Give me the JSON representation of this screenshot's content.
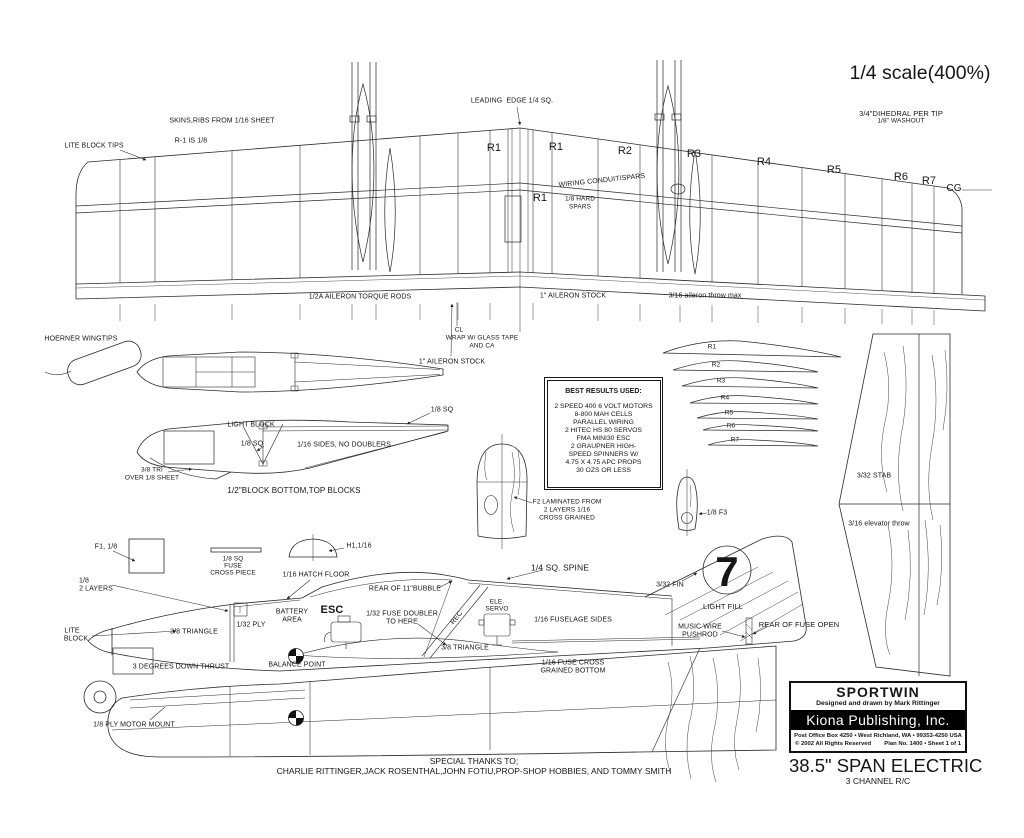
{
  "page": {
    "background": "#ffffff",
    "ink": "#161616"
  },
  "scale_note": "1/4 scale(400%)",
  "title_block": {
    "plane_name": "SPORTWIN",
    "designer_line": "Designed and drawn by Mark Rittinger",
    "publisher": "Kiona Publishing, Inc.",
    "address_line": "Post Office Box 4250 • West Richland, WA • 99353-4250 USA",
    "copyright_line": "© 2002 All Rights Reserved",
    "plan_number_line": "Plan No. 1400 • Sheet 1 of 1",
    "span_line": "38.5\" SPAN ELECTRIC",
    "channels_line": "3 CHANNEL R/C"
  },
  "thanks": {
    "line1": "SPECIAL THANKS TO;",
    "line2": "CHARLIE RITTINGER,JACK ROSENTHAL,JOHN FOTIU,PROP-SHOP HOBBIES, AND TOMMY SMITH"
  },
  "notes_box": {
    "title": "BEST RESULTS USED:",
    "lines": [
      "2 SPEED 400 6 VOLT MOTORS",
      "8-800 MAH CELLS",
      "PARALLEL WIRING",
      "2 HITEC HS 80 SERVOS",
      "FMA MINI30 ESC",
      "2 GRAUPNER HIGH-",
      "SPEED SPINNERS W/",
      "4.75 X 4.75 APC PROPS",
      "30 OZS OR LESS"
    ]
  },
  "labels": [
    {
      "name": "leading-edge",
      "text": "LEADING  EDGE 1/4 SQ.",
      "x": 512,
      "y": 101
    },
    {
      "name": "skins-ribs",
      "text": "SKINS,RIBS FROM 1/16 SHEET",
      "x": 222,
      "y": 121
    },
    {
      "name": "r1-is-eighth",
      "text": "R-1 IS 1/8",
      "x": 191,
      "y": 141
    },
    {
      "name": "lite-block-tips",
      "text": "LITE BLOCK TIPS",
      "x": 94,
      "y": 146
    },
    {
      "name": "dihedral",
      "text": "3/4\"DIHEDRAL PER TIP",
      "x": 901,
      "y": 114,
      "size": 7.5
    },
    {
      "name": "washout",
      "text": "1/8\" WASHOUT",
      "x": 901,
      "y": 122,
      "size": 6.5
    },
    {
      "name": "rib-r1-left",
      "text": "R1",
      "x": 494,
      "y": 149,
      "size": 11
    },
    {
      "name": "rib-r1-mid",
      "text": "R1",
      "x": 556,
      "y": 148,
      "size": 11
    },
    {
      "name": "rib-r2",
      "text": "R2",
      "x": 625,
      "y": 152,
      "size": 11
    },
    {
      "name": "rib-r3",
      "text": "R3",
      "x": 694,
      "y": 155,
      "size": 11
    },
    {
      "name": "rib-r4",
      "text": "R4",
      "x": 764,
      "y": 163,
      "size": 11
    },
    {
      "name": "rib-r5",
      "text": "R5",
      "x": 834,
      "y": 171,
      "size": 11
    },
    {
      "name": "rib-r6",
      "text": "R6",
      "x": 901,
      "y": 178,
      "size": 11
    },
    {
      "name": "rib-r7",
      "text": "R7",
      "x": 929,
      "y": 182,
      "size": 11
    },
    {
      "name": "cg-label",
      "text": "CG",
      "x": 954,
      "y": 189,
      "size": 10
    },
    {
      "name": "rib-r1-center",
      "text": "R1",
      "x": 540,
      "y": 199,
      "size": 11
    },
    {
      "name": "wiring-conduit",
      "text": "WIRING CONDUIT/SPARS",
      "x": 602,
      "y": 181,
      "rotate": -6
    },
    {
      "name": "hard-spars-1",
      "text": "1/8 HARD",
      "x": 580,
      "y": 200,
      "size": 6.5
    },
    {
      "name": "hard-spars-2",
      "text": "SPARS",
      "x": 580,
      "y": 208,
      "size": 6.5
    },
    {
      "name": "torque-rods",
      "text": "1/2A AILERON TORQUE RODS",
      "x": 360,
      "y": 297
    },
    {
      "name": "aileron-stock-top",
      "text": "1\" AILERON STOCK",
      "x": 573,
      "y": 296
    },
    {
      "name": "aileron-throw",
      "text": "3/16 aileron throw max",
      "x": 705,
      "y": 296
    },
    {
      "name": "cl-mark",
      "text": "CL",
      "x": 459,
      "y": 331,
      "size": 6.5
    },
    {
      "name": "wrap-glass-1",
      "text": "WRAP W/ GLASS TAPE",
      "x": 482,
      "y": 339,
      "size": 6.5
    },
    {
      "name": "wrap-glass-2",
      "text": "AND CA",
      "x": 482,
      "y": 347,
      "size": 6.5
    },
    {
      "name": "aileron-stock-lower",
      "text": "1\" AILERON STOCK",
      "x": 452,
      "y": 362
    },
    {
      "name": "hoerner",
      "text": "HOERNER WINGTIPS",
      "x": 81,
      "y": 339
    },
    {
      "name": "light-block",
      "text": "LIGHT BLOCK",
      "x": 251,
      "y": 425
    },
    {
      "name": "sq-top-right",
      "text": "1/8 SQ",
      "x": 442,
      "y": 410
    },
    {
      "name": "sq-mid",
      "text": "1/8 SQ",
      "x": 252,
      "y": 444
    },
    {
      "name": "sides-no-doublers",
      "text": "1/16 SIDES, NO DOUBLERS",
      "x": 344,
      "y": 445
    },
    {
      "name": "tri-38",
      "text": "3/8 TRI",
      "x": 152,
      "y": 471,
      "size": 6.5
    },
    {
      "name": "over-18-sheet",
      "text": "OVER 1/8 SHEET",
      "x": 152,
      "y": 479,
      "size": 6.5
    },
    {
      "name": "block-bottom",
      "text": "1/2\"BLOCK BOTTOM,TOP BLOCKS",
      "x": 294,
      "y": 491,
      "size": 8
    },
    {
      "name": "f2-line1",
      "text": "F2 LAMINATED FROM",
      "x": 567,
      "y": 503,
      "size": 6.5
    },
    {
      "name": "f2-line2",
      "text": "2 LAYERS 1/16",
      "x": 567,
      "y": 511,
      "size": 6.5
    },
    {
      "name": "f2-line3",
      "text": "CROSS GRAINED",
      "x": 567,
      "y": 519,
      "size": 6.5
    },
    {
      "name": "tpl-r1",
      "text": "R1",
      "x": 712,
      "y": 348,
      "size": 6.5
    },
    {
      "name": "tpl-r2",
      "text": "R2",
      "x": 716,
      "y": 366,
      "size": 6.5
    },
    {
      "name": "tpl-r3",
      "text": "R3",
      "x": 721,
      "y": 382,
      "size": 6.5
    },
    {
      "name": "tpl-r4",
      "text": "R4",
      "x": 725,
      "y": 399,
      "size": 6.5
    },
    {
      "name": "tpl-r5",
      "text": "R5",
      "x": 729,
      "y": 414,
      "size": 6.5
    },
    {
      "name": "tpl-r6",
      "text": "R6",
      "x": 731,
      "y": 427,
      "size": 6.5
    },
    {
      "name": "tpl-r7",
      "text": "R7",
      "x": 735,
      "y": 441,
      "size": 6.5
    },
    {
      "name": "stab",
      "text": "3/32 STAB",
      "x": 874,
      "y": 476
    },
    {
      "name": "elevator-throw",
      "text": "3/16 elevator throw",
      "x": 879,
      "y": 524
    },
    {
      "name": "f3",
      "text": "1/8 F3",
      "x": 717,
      "y": 513
    },
    {
      "name": "f1",
      "text": "F1, 1/8",
      "x": 106,
      "y": 547
    },
    {
      "name": "cross-piece-1",
      "text": "1/8 SQ",
      "x": 233,
      "y": 560,
      "size": 6.5
    },
    {
      "name": "cross-piece-2",
      "text": "FUSE",
      "x": 233,
      "y": 567,
      "size": 6.5
    },
    {
      "name": "cross-piece-3",
      "text": "CROSS PIECE",
      "x": 233,
      "y": 574,
      "size": 6.5
    },
    {
      "name": "h1",
      "text": "H1,1/16",
      "x": 359,
      "y": 546
    },
    {
      "name": "hatch-floor",
      "text": "1/16 HATCH FLOOR",
      "x": 316,
      "y": 575
    },
    {
      "name": "rear-bubble",
      "text": "REAR OF 11\"BUBBLE",
      "x": 405,
      "y": 589
    },
    {
      "name": "layers-1",
      "text": "1/8",
      "x": 84,
      "y": 581
    },
    {
      "name": "layers-2",
      "text": "2 LAYERS",
      "x": 96,
      "y": 589
    },
    {
      "name": "lite",
      "text": "LITE",
      "x": 72,
      "y": 631
    },
    {
      "name": "block",
      "text": "BLOCK",
      "x": 76,
      "y": 639
    },
    {
      "name": "triangle-fwd",
      "text": "3/8 TRIANGLE",
      "x": 194,
      "y": 632
    },
    {
      "name": "ply-132",
      "text": "1/32 PLY",
      "x": 251,
      "y": 625
    },
    {
      "name": "battery-1",
      "text": "BATTERY",
      "x": 292,
      "y": 612
    },
    {
      "name": "battery-2",
      "text": "AREA",
      "x": 292,
      "y": 620
    },
    {
      "name": "esc",
      "text": "ESC",
      "x": 332,
      "y": 611,
      "size": 11,
      "bold": true
    },
    {
      "name": "doubler-1",
      "text": "1/32 FUSE DOUBLER",
      "x": 402,
      "y": 614
    },
    {
      "name": "doubler-2",
      "text": "TO HERE",
      "x": 402,
      "y": 622
    },
    {
      "name": "rec",
      "text": "REC",
      "x": 457,
      "y": 618,
      "rotate": -52
    },
    {
      "name": "ele",
      "text": "ELE.",
      "x": 497,
      "y": 603,
      "size": 6.5
    },
    {
      "name": "servo",
      "text": "SERVO",
      "x": 497,
      "y": 610,
      "size": 6.5
    },
    {
      "name": "fuselage-sides",
      "text": "1/16 FUSELAGE SIDES",
      "x": 573,
      "y": 620
    },
    {
      "name": "spine",
      "text": "1/4 SQ. SPINE",
      "x": 560,
      "y": 568,
      "size": 8.5
    },
    {
      "name": "fin-332",
      "text": "3/32 FIN",
      "x": 670,
      "y": 585
    },
    {
      "name": "light-fill",
      "text": "LIGHT FILL",
      "x": 723,
      "y": 607,
      "size": 7.5
    },
    {
      "name": "music-wire-1",
      "text": "MUSIC WIRE",
      "x": 700,
      "y": 627
    },
    {
      "name": "music-wire-2",
      "text": "PUSHROD",
      "x": 700,
      "y": 635
    },
    {
      "name": "fuse-open",
      "text": "REAR OF FUSE OPEN",
      "x": 799,
      "y": 625,
      "size": 7.5
    },
    {
      "name": "triangle-aft",
      "text": "3/8 TRIANGLE",
      "x": 465,
      "y": 648
    },
    {
      "name": "fuse-cross-1",
      "text": "1/16 FUSE CROSS",
      "x": 573,
      "y": 663
    },
    {
      "name": "fuse-cross-2",
      "text": "GRAINED BOTTOM",
      "x": 573,
      "y": 671
    },
    {
      "name": "down-thrust",
      "text": "3 DEGREES DOWN THRUST",
      "x": 181,
      "y": 667
    },
    {
      "name": "balance-point",
      "text": "BALANCE POINT",
      "x": 297,
      "y": 665
    },
    {
      "name": "motor-mount",
      "text": "1/8 PLY MOTOR MOUNT",
      "x": 134,
      "y": 725
    },
    {
      "name": "fin-number",
      "text": "7",
      "x": 727,
      "y": 572,
      "size": 42,
      "bold": true
    }
  ]
}
